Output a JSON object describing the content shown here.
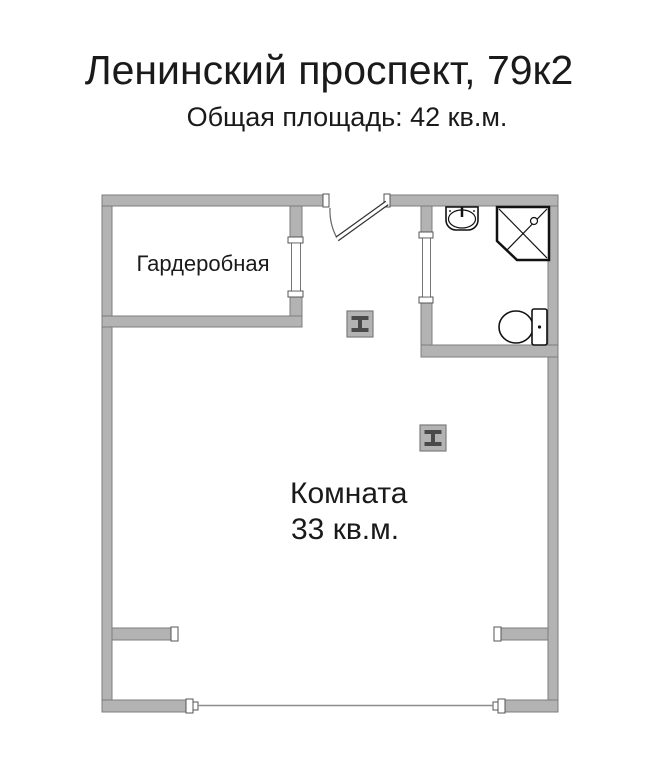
{
  "header": {
    "title": "Ленинский проспект, 79к2",
    "subtitle": "Общая площадь: 42 кв.м."
  },
  "rooms": {
    "wardrobe": {
      "label": "Гардеробная"
    },
    "main_room": {
      "label": "Комната",
      "area": "33 кв.м."
    }
  },
  "fixtures": [
    {
      "name": "sink-icon"
    },
    {
      "name": "shower-icon"
    },
    {
      "name": "toilet-icon"
    },
    {
      "name": "steel-column-icon"
    },
    {
      "name": "steel-column-icon"
    },
    {
      "name": "entrance-door-icon"
    },
    {
      "name": "balcony-window-icon"
    }
  ],
  "colors": {
    "wall_fill": "#b3b3b3",
    "wall_outline": "#7d7d7d",
    "jamb_outline": "#555555",
    "fixture_stroke": "#111111",
    "door_arc": "#666666",
    "window_line": "#8c8c8c",
    "column_glyph": "#4a4a4a",
    "text_color": "#1a1a1a"
  }
}
